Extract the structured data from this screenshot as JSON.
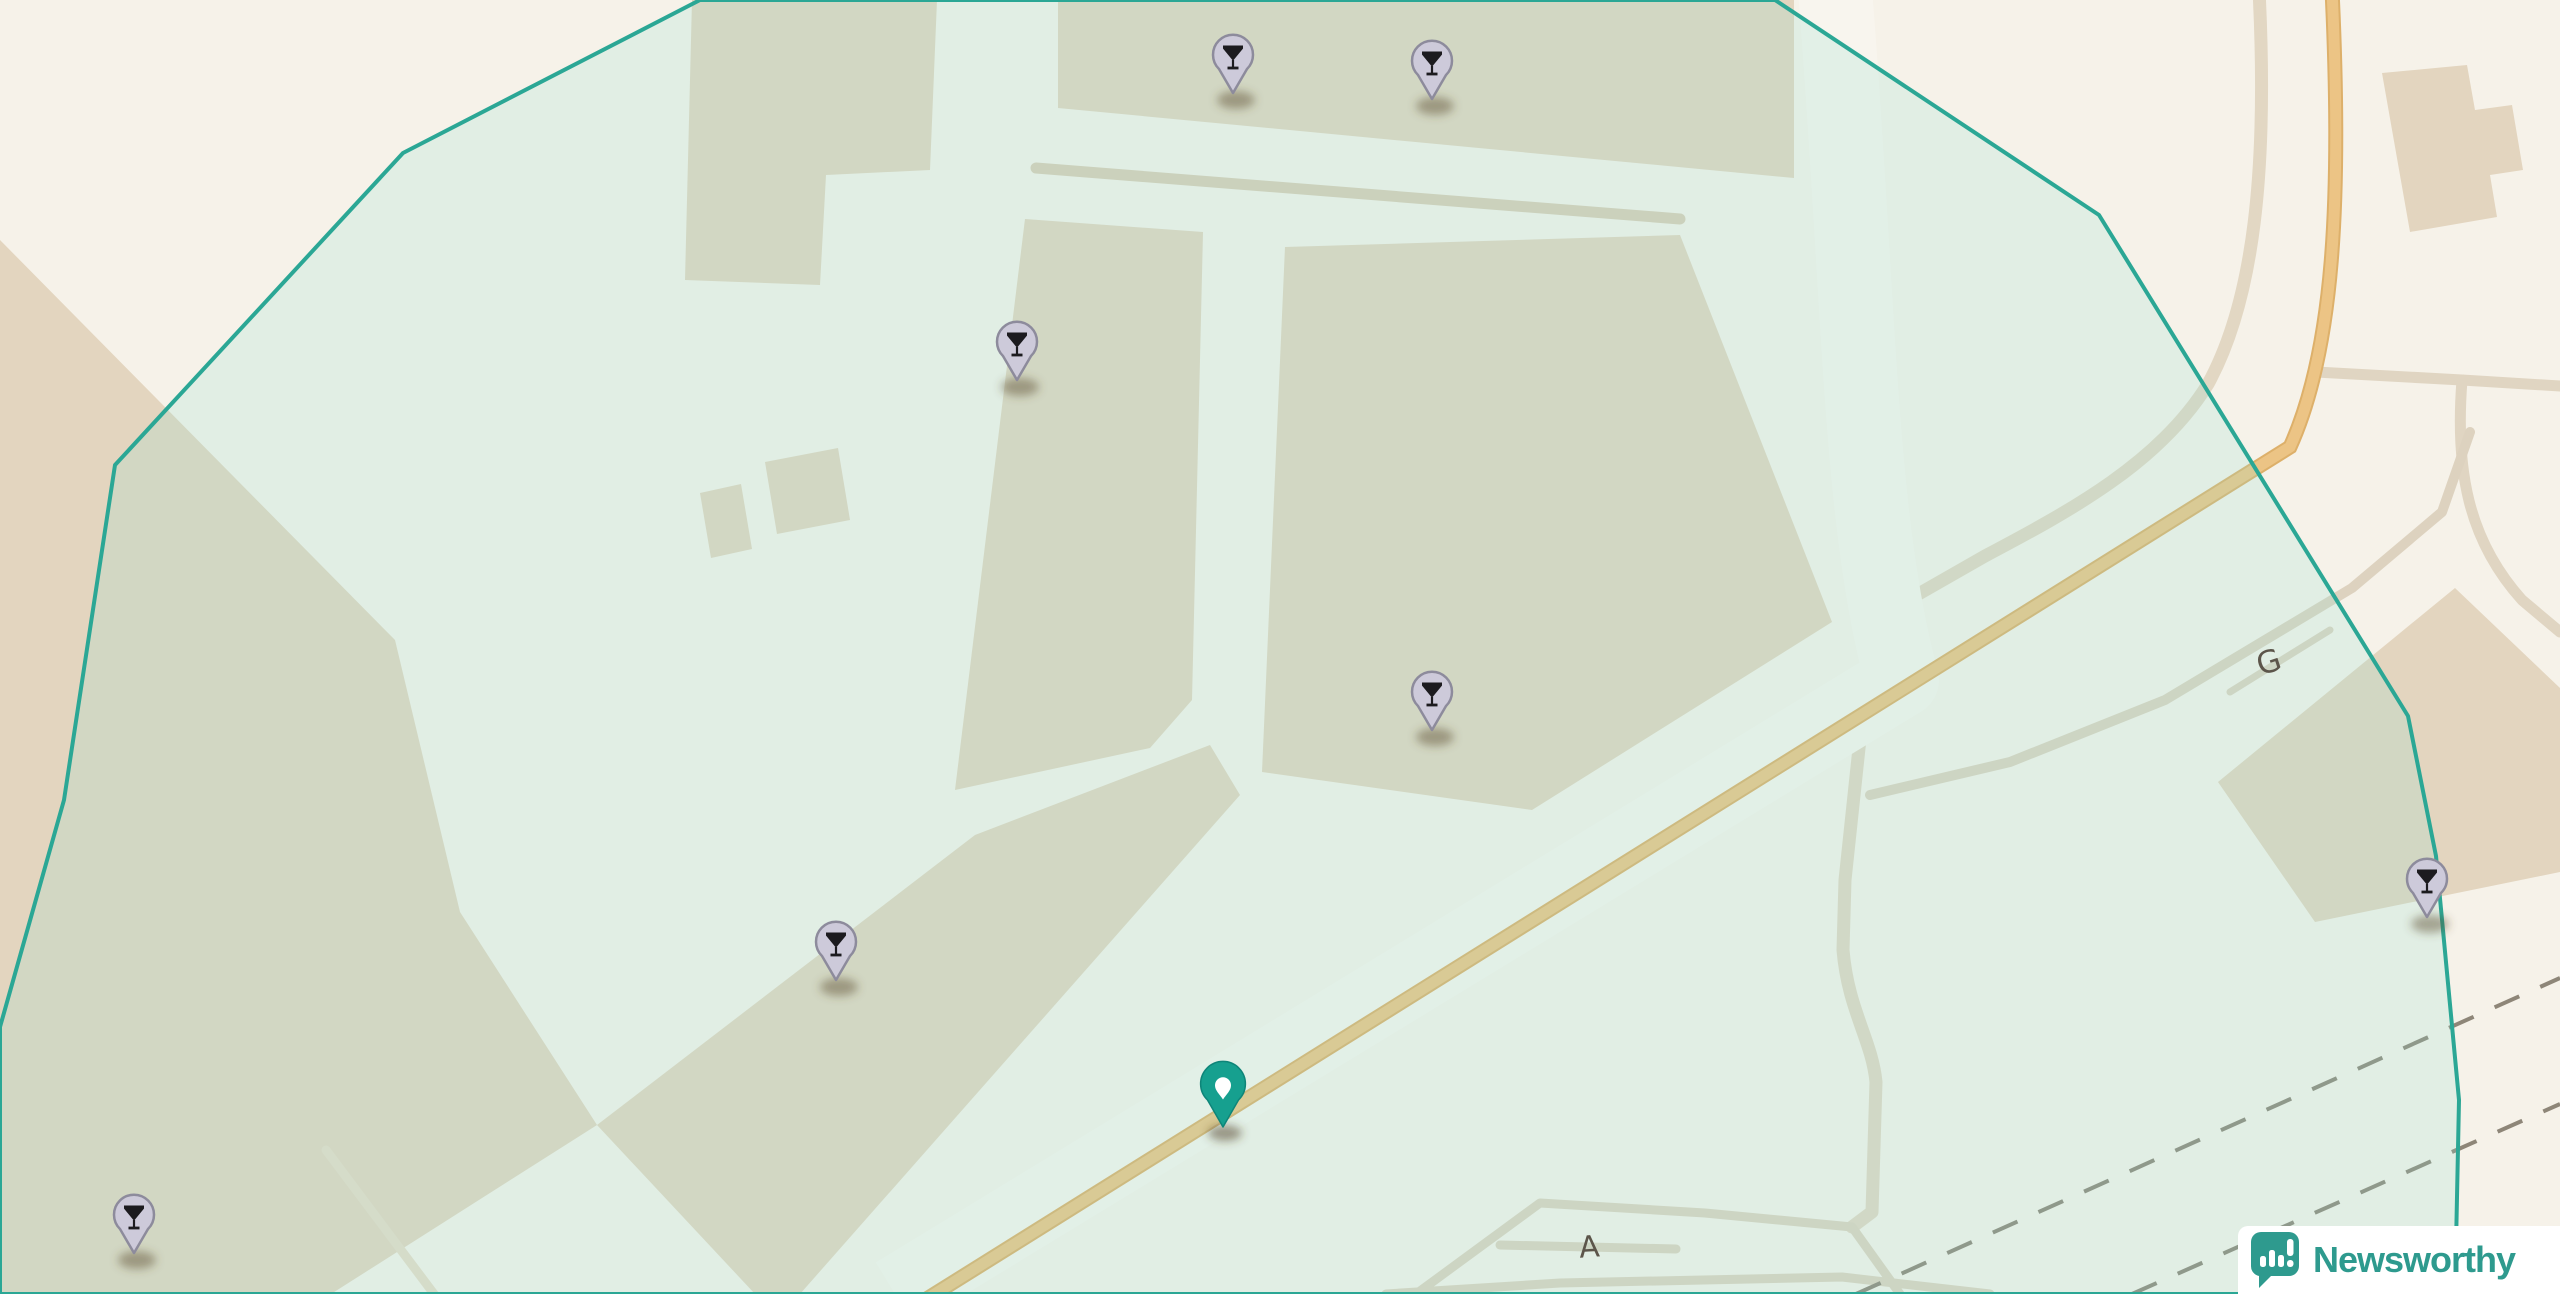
{
  "map": {
    "road_labels": [
      {
        "text": "G",
        "x": 2272,
        "y": 672,
        "rotate": -18,
        "size": 31
      },
      {
        "text": "A",
        "x": 1590,
        "y": 1257,
        "rotate": -4,
        "size": 30
      }
    ],
    "markers": {
      "poi_type": "cocktail-bar",
      "poi": [
        {
          "x": 1233,
          "y": 93
        },
        {
          "x": 1432,
          "y": 99
        },
        {
          "x": 1017,
          "y": 380
        },
        {
          "x": 1432,
          "y": 730
        },
        {
          "x": 836,
          "y": 980
        },
        {
          "x": 134,
          "y": 1253
        },
        {
          "x": 2427,
          "y": 917
        }
      ],
      "selected": {
        "x": 1223,
        "y": 1127
      }
    },
    "colors": {
      "land": "#f6f2e9",
      "building": "#e3d5bf",
      "boundary_stroke": "#2ba795",
      "boundary_fill": "rgba(151,224,211,0.22)",
      "road_primary": "#ecc485",
      "road_primary_casing": "#ddb06a",
      "road_minor": "#ddd2bf",
      "road_white": "#f8f5ee",
      "railway_dash": "#8e8678",
      "poi_pin_fill": "#cdcada",
      "poi_pin_stroke": "#8d8b9c",
      "poi_glyph": "#1c1b1f",
      "selected_pin_fill": "#16a08f",
      "selected_pin_stroke": "#0e8579"
    }
  },
  "branding": {
    "logo_text": "Newsworthy",
    "logo_icon": "bar-chart-speech-bubble",
    "logo_color": "#2e9a8e"
  }
}
